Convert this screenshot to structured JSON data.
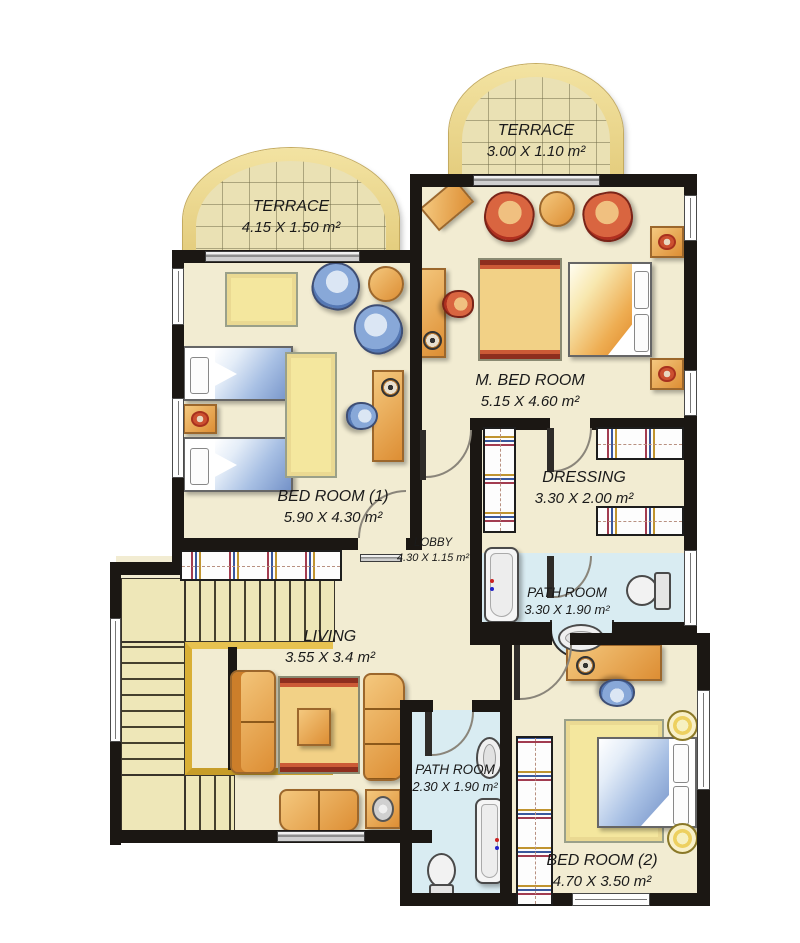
{
  "plan": {
    "rooms": {
      "terrace_left": {
        "name": "TERRACE",
        "dims": "4.15 X 1.50 m²"
      },
      "terrace_top": {
        "name": "TERRACE",
        "dims": "3.00 X 1.10 m²"
      },
      "m_bedroom": {
        "name": "M. BED ROOM",
        "dims": "5.15 X 4.60 m²"
      },
      "bedroom_1": {
        "name": "BED ROOM (1)",
        "dims": "5.90 X 4.30 m²"
      },
      "dressing": {
        "name": "DRESSING",
        "dims": "3.30 X 2.00 m²"
      },
      "lobby": {
        "name": "LOBBY",
        "dims": "4.30 X 1.15 m²"
      },
      "path_room_1": {
        "name": "PATH ROOM",
        "dims": "3.30 X 1.90  m²"
      },
      "living": {
        "name": "LIVING",
        "dims": "3.55 X 3.4 m²"
      },
      "path_room_2": {
        "name": "PATH ROOM",
        "dims": "2.30 X 1.90 m²"
      },
      "bedroom_2": {
        "name": "BED ROOM (2)",
        "dims": "4.70 X 3.50 m²"
      }
    },
    "colors": {
      "wall": "#1b1713",
      "floor": "#f2ecd2",
      "terrace_floor": "#eae1b4",
      "terrace_trim": "#ecd88e",
      "bath_floor": "#d9ecf2",
      "furniture_orange": "#e09038",
      "accent_red": "#c23b2a",
      "bedding_blue": "#7b9cd0",
      "rug_yellow": "#f4e79e",
      "stair_gold": "#d9af35"
    }
  }
}
